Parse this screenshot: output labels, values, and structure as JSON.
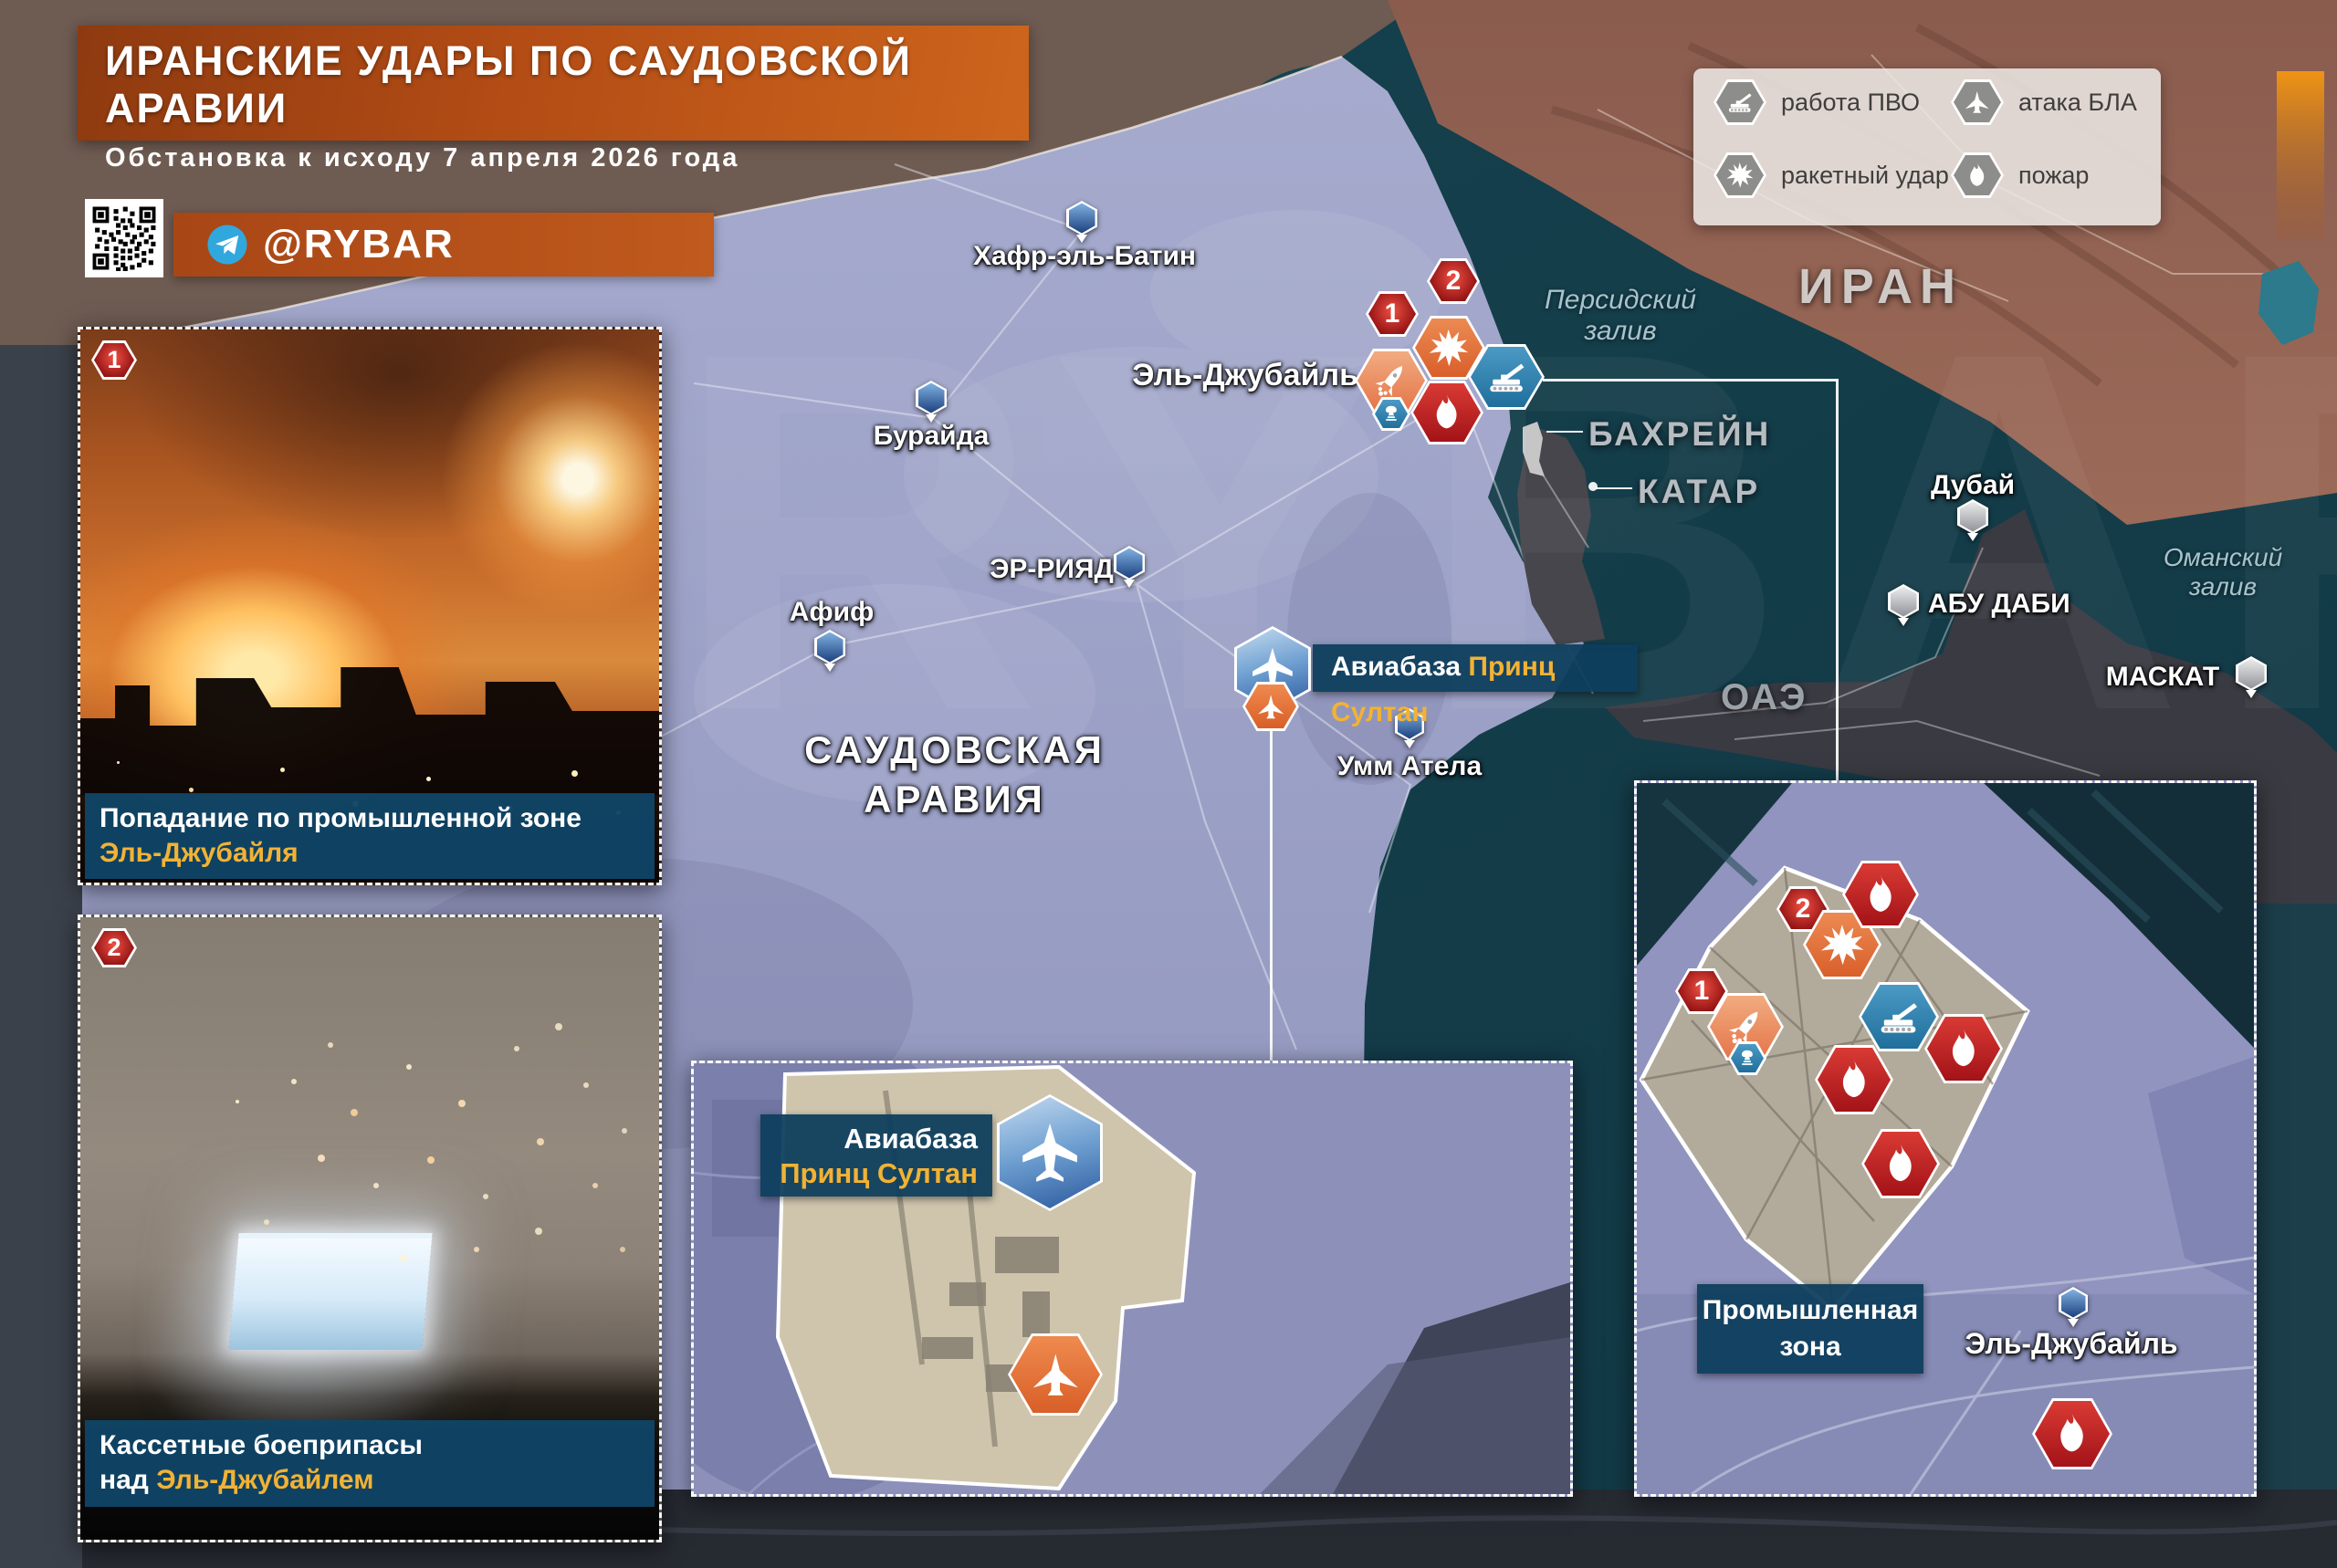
{
  "header": {
    "title": "ИРАНСКИЕ УДАРЫ ПО САУДОВСКОЙ АРАВИИ",
    "subtitle": "Обстановка к исходу 7 апреля 2026 года",
    "channel": "@RYBAR"
  },
  "legend": {
    "items": [
      {
        "icon": "air-defense-icon",
        "label": "работа ПВО"
      },
      {
        "icon": "uav-attack-icon",
        "label": "атака БЛА"
      },
      {
        "icon": "missile-strike-icon",
        "label": "ракетный удар"
      },
      {
        "icon": "fire-icon",
        "label": "пожар"
      }
    ]
  },
  "map": {
    "countries": {
      "saudi_line1": "САУДОВСКАЯ",
      "saudi_line2": "АРАВИЯ",
      "iran": "ИРАН",
      "bahrain": "БАХРЕЙН",
      "qatar": "КАТАР",
      "uae": "ОАЭ"
    },
    "water": {
      "persian_line1": "Персидский",
      "persian_line2": "залив",
      "oman_line1": "Оманский",
      "oman_line2": "залив"
    },
    "cities": [
      {
        "name": "Хафр-эль-Батин"
      },
      {
        "name": "Бурайда"
      },
      {
        "name": "Эль-Джубайль"
      },
      {
        "name": "ЭР-РИЯД"
      },
      {
        "name": "Афиф"
      },
      {
        "name": "Умм Атела"
      },
      {
        "name": "Дубай"
      },
      {
        "name": "АБУ ДАБИ"
      },
      {
        "name": "МАСКАТ"
      }
    ],
    "airbase_label": {
      "white": "Авиабаза",
      "orange": "Принц Султан"
    },
    "strike_numbers": [
      "1",
      "2"
    ]
  },
  "insets": {
    "photo1": {
      "number": "1",
      "caption_line1": "Попадание по промышленной зоне",
      "caption_line2": "Эль-Джубайля"
    },
    "photo2": {
      "number": "2",
      "caption_line1": "Кассетные боеприпасы",
      "caption_prefix": "над ",
      "caption_highlight": "Эль-Джубайлем"
    },
    "airbase": {
      "white": "Авиабаза",
      "orange": "Принц Султан"
    },
    "industrial": {
      "zone_line1": "Промышленная",
      "zone_line2": "зона",
      "city": "Эль-Джубайль",
      "numbers": [
        "1",
        "2"
      ]
    }
  },
  "colors": {
    "accent_orange": "#c05a1d",
    "caption_blue": "#104566",
    "highlight_orange": "#f2b234",
    "fire_red": "#b5222a",
    "strike_orange": "#e3773f",
    "pvo_blue": "#2e7ca8",
    "telegram_blue": "#31a8dd"
  }
}
